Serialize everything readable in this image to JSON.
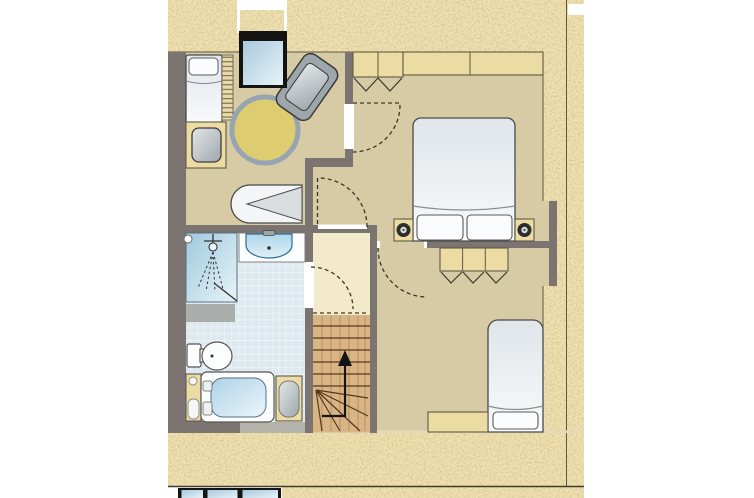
{
  "drawing": {
    "type": "apartment-floor-plan",
    "floor_shown": "attic-bedroom-level",
    "visible_text": "",
    "rooms": [
      {
        "name": "bedroom-left",
        "floor": "tan",
        "furniture": [
          "single-bed",
          "ladder-rack",
          "dresser-with-stool",
          "round-table",
          "armchair",
          "lounge-chair",
          "dormer-window"
        ]
      },
      {
        "name": "bedroom-right",
        "floor": "tan",
        "furniture": [
          "double-bed",
          "nightstand-left",
          "nightstand-right",
          "wardrobe-two-door",
          "wardrobe-long"
        ]
      },
      {
        "name": "bedroom-small",
        "floor": "tan",
        "furniture": [
          "wardrobe-three-door",
          "single-bed",
          "desk"
        ]
      },
      {
        "name": "bathroom",
        "floor": "blue-tiles",
        "furniture": [
          "shower",
          "washbasin",
          "toilet",
          "bathtub",
          "storage-cabinet",
          "laundry-basket"
        ]
      },
      {
        "name": "hallway-landing",
        "floor": "cream",
        "furniture": [
          "staircase"
        ]
      }
    ],
    "doors": [
      {
        "from": "hallway-landing",
        "to": "bathroom",
        "symbol": "dashed-swing-arc"
      },
      {
        "from": "hallway-landing",
        "to": "vestibule-bedroom-right",
        "symbol": "dashed-swing-arc"
      },
      {
        "from": "bedroom-right",
        "to": "bedroom-left",
        "symbol": "dashed-swing-arc"
      },
      {
        "from": "vestibule-bedroom-right",
        "to": "bedroom-small",
        "symbol": "dashed-swing-arc"
      }
    ],
    "stairs": {
      "direction": "up",
      "symbol": "up-arrow",
      "style": "winder-staircase"
    },
    "surroundings": "speckled-roof-texture-border",
    "cutoff_lower_plan": {
      "windows": 3,
      "position": "bottom-left-strip"
    }
  },
  "palette": {
    "wall": "#7b7471",
    "floor": "#d6cba4",
    "landing": "#f3eacc",
    "tile": "#dee8ef",
    "tile_line": "#f4f8fb",
    "texture_base": "#eee0b0",
    "texture_speck": "#a67c42",
    "wood": "#ecdca4",
    "wood_line": "#5f5946",
    "stair_wood": "#d9b586",
    "stair_line": "#53391f",
    "bed_light": "#f8fafb",
    "bed_dark": "#dfe5e9",
    "outline": "#4a4a4a",
    "dash": "#3a362b",
    "glass_light": "#e6f3f9",
    "glass_dark": "#a9c9dd",
    "water_light": "#ebf6fb",
    "water_dark": "#aed2e6",
    "table_top": "#ddcd70",
    "table_ring": "#97a5b2",
    "chair_gray": "#9fa6ab",
    "frame_black": "#141414",
    "gray_block": "#a9aeab",
    "divider_line": "#5e5744"
  }
}
